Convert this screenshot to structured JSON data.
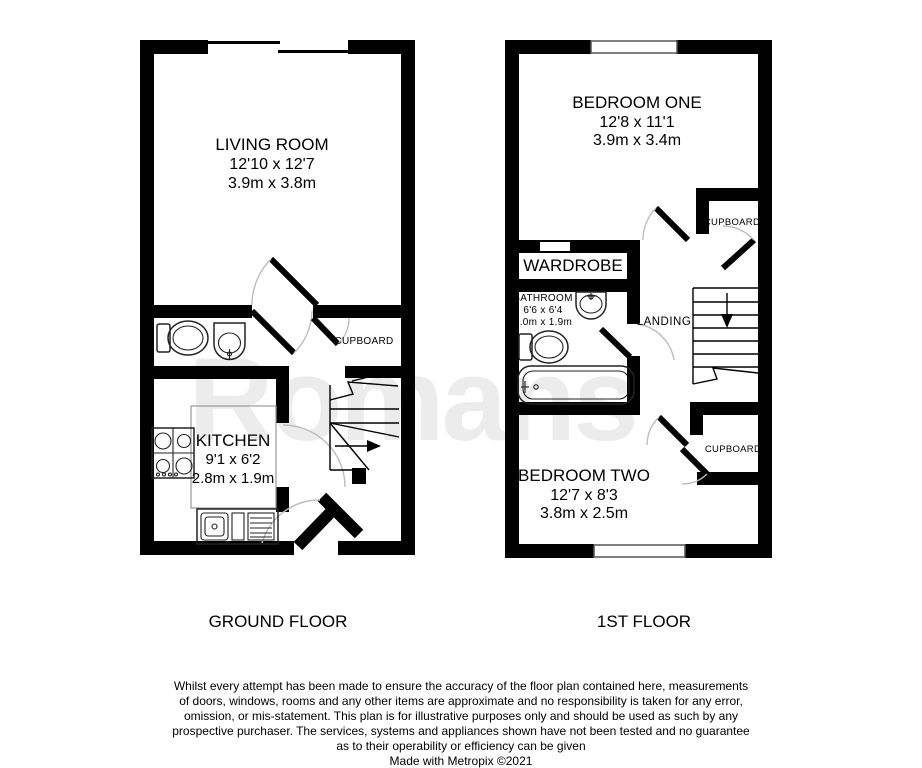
{
  "watermark": "Romans",
  "ground_floor": {
    "label": "GROUND FLOOR",
    "living_room": {
      "name": "LIVING ROOM",
      "imperial": "12'10 x 12'7",
      "metric": "3.9m x 3.8m"
    },
    "kitchen": {
      "name": "KITCHEN",
      "imperial": "9'1 x 6'2",
      "metric": "2.8m x 1.9m"
    },
    "cupboard": {
      "name": "CUPBOARD"
    }
  },
  "first_floor": {
    "label": "1ST FLOOR",
    "bedroom_one": {
      "name": "BEDROOM ONE",
      "imperial": "12'8 x 11'1",
      "metric": "3.9m x 3.4m"
    },
    "bedroom_two": {
      "name": "BEDROOM TWO",
      "imperial": "12'7 x 8'3",
      "metric": "3.8m x 2.5m"
    },
    "bathroom": {
      "name": "BATHROOM",
      "imperial": "6'6 x 6'4",
      "metric": "2.0m x 1.9m"
    },
    "wardrobe": {
      "name": "WARDROBE"
    },
    "landing": {
      "name": "LANDING"
    },
    "cupboard_upper": {
      "name": "CUPBOARD"
    },
    "cupboard_lower": {
      "name": "CUPBOARD"
    }
  },
  "footer": {
    "disclaimer_lines": [
      "Whilst every attempt has been made to ensure the accuracy of the floor plan contained here, measurements",
      "of doors, windows, rooms and any other items are approximate and no responsibility is taken for any error,",
      "omission, or mis-statement. This plan is for illustrative purposes only and should be used as such by any",
      "prospective purchaser. The services, systems and appliances shown have not been tested and no guarantee",
      "as to their operability or efficiency can be given"
    ],
    "credit": "Made with Metropix ©2021"
  }
}
